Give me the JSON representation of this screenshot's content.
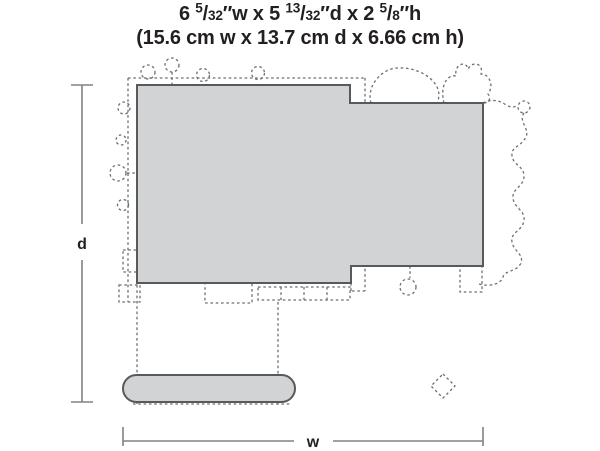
{
  "title": {
    "line1_parts": [
      {
        "text": "6 "
      },
      {
        "sup": "5"
      },
      {
        "text": "/"
      },
      {
        "den": "32"
      },
      {
        "text": "″w x 5 "
      },
      {
        "sup": "13"
      },
      {
        "text": "/"
      },
      {
        "den": "32"
      },
      {
        "text": "″d x 2 "
      },
      {
        "sup": "5"
      },
      {
        "text": "/"
      },
      {
        "den": "8"
      },
      {
        "text": "″h"
      }
    ],
    "line2": "(15.6 cm w x 13.7 cm d x 6.66 cm h)"
  },
  "diagram": {
    "depth_label": "d",
    "width_label": "w",
    "colors": {
      "fill": "#d1d3d4",
      "outline": "#58595b",
      "dashed": "#6d6e71",
      "dimension": "#808285",
      "text": "#231f20"
    }
  }
}
